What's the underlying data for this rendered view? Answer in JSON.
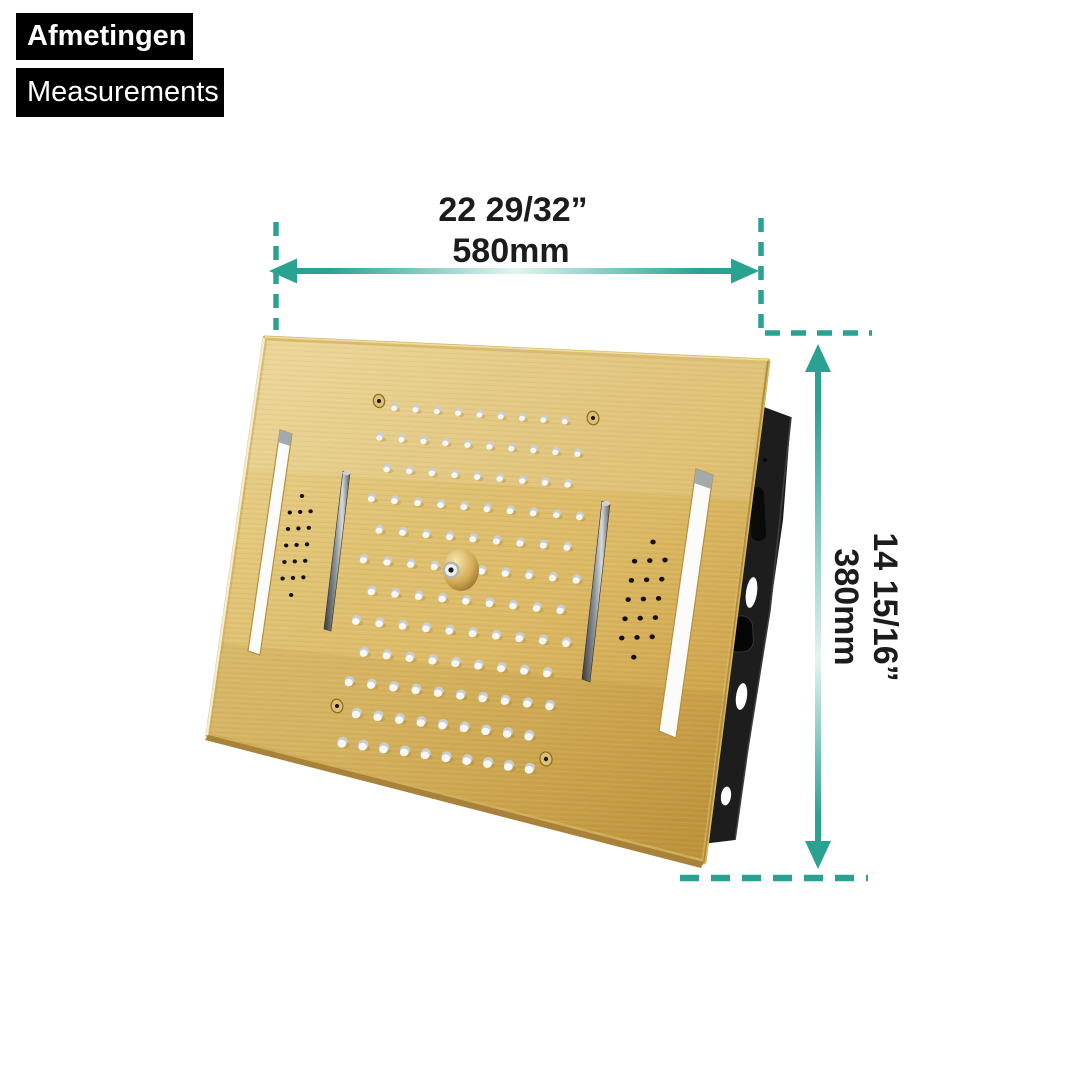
{
  "page": {
    "background": "#ffffff"
  },
  "header": {
    "title_nl": "Afmetingen",
    "title_en": "Measurements"
  },
  "dimensions": {
    "width": {
      "imperial": "22 29/32”",
      "metric": "580mm"
    },
    "height": {
      "imperial": "14 15/16”",
      "metric": "380mm"
    }
  },
  "figure": {
    "subject": "brushed gold recessed ceiling rain-shower head panel with two LED light strips, two waterfall slots, two speaker perforation grids, four screws and a central brass mist nozzle, shown in perspective with a black mounting bracket behind its right edge"
  },
  "icons": {
    "width_arrow": "horizontal-double-arrow-icon",
    "height_arrow": "vertical-double-arrow-icon",
    "extension_lines": "teal-dashed-extension-lines"
  },
  "colors": {
    "accent": "#2aa292",
    "accent_light": "#e3f4f0",
    "label_bg": "#000000",
    "label_text": "#ffffff",
    "dimension_text": "#1c1c1c",
    "panel_gold": "#dcb964",
    "panel_gold_dark": "#c49a41",
    "panel_gold_light": "#e8cf87",
    "bracket_black": "#1d1d1d",
    "nozzle_white": "#f6f7f6",
    "nozzle_gray": "#c9ced1"
  },
  "product_render": {
    "nozzle_rows": 12,
    "nozzles_per_row_even": 9,
    "nozzles_per_row_odd": 10,
    "speaker_grid_pattern": [
      1,
      3,
      3,
      3,
      3,
      3,
      1
    ]
  }
}
